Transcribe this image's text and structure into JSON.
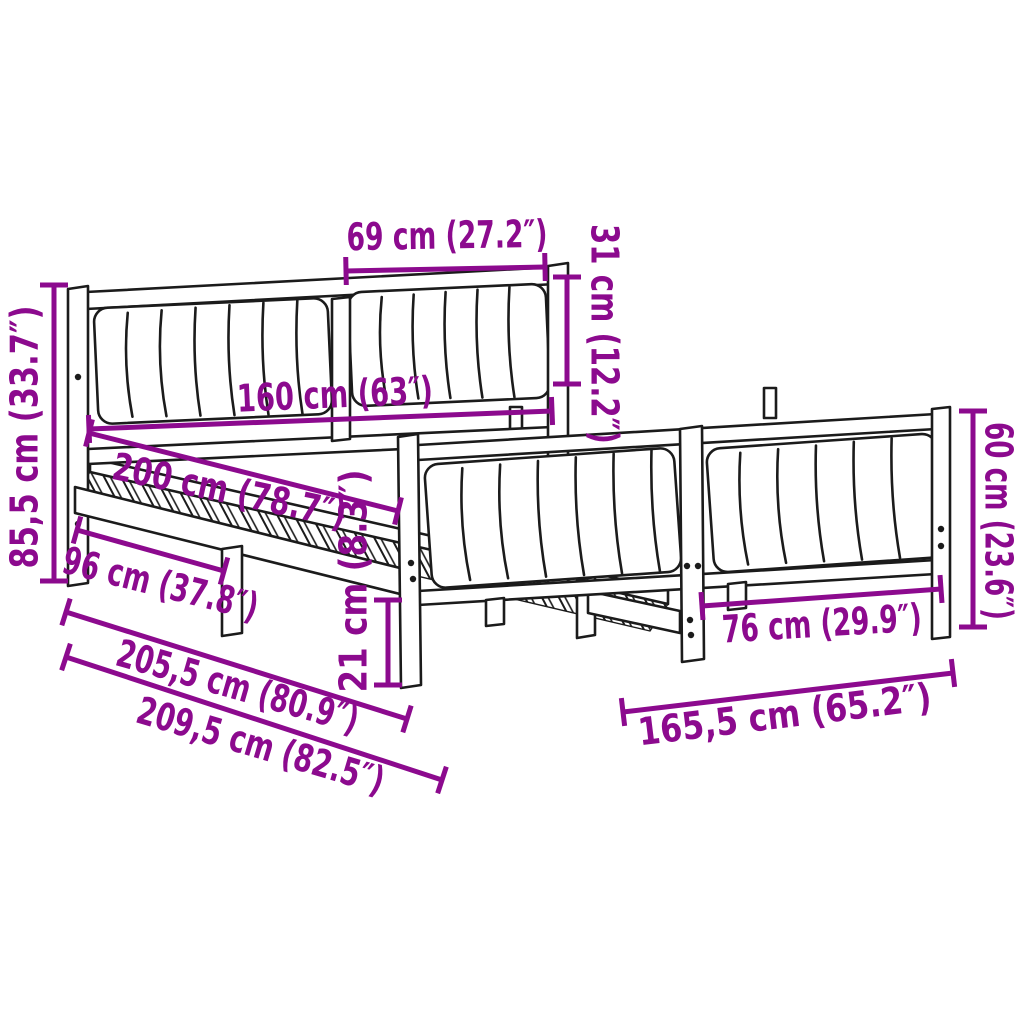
{
  "meta": {
    "description": "Bed frame with upholstered headboard and footboard - product dimension diagram",
    "background": "#ffffff"
  },
  "colors": {
    "dimension": "#8c0a8e",
    "line_art": "#1b1b1b"
  },
  "dimensions": [
    {
      "id": "headboard-cushion-width",
      "label": "69 cm (27.2″)",
      "line": {
        "x1": 346,
        "y1": 271,
        "x2": 545,
        "y2": 267
      },
      "text": {
        "x": 447,
        "y": 238,
        "rotate": -1,
        "len": 201
      }
    },
    {
      "id": "headboard-cushion-height",
      "label": "31 cm (12.2″)",
      "line": {
        "x1": 567,
        "y1": 277,
        "x2": 567,
        "y2": 384
      },
      "text": {
        "x": 602,
        "y": 334,
        "rotate": 90,
        "len": 220
      }
    },
    {
      "id": "bed-width",
      "label": "160 cm (63″)",
      "line": {
        "x1": 89,
        "y1": 429,
        "x2": 552,
        "y2": 411
      },
      "text": {
        "x": 335,
        "y": 397,
        "rotate": -2.5,
        "len": 196
      }
    },
    {
      "id": "bed-length",
      "label": "200 cm (78.7″)",
      "line": {
        "x1": 89,
        "y1": 433,
        "x2": 398,
        "y2": 511
      },
      "text": {
        "x": 229,
        "y": 493,
        "rotate": 12,
        "len": 238
      }
    },
    {
      "id": "headboard-height",
      "label": "85,5 cm (33.7″)",
      "line": {
        "x1": 54,
        "y1": 285,
        "x2": 54,
        "y2": 581
      },
      "text": {
        "x": 27,
        "y": 437,
        "rotate": -90,
        "len": 263
      }
    },
    {
      "id": "head-to-center-leg",
      "label": "96 cm (37.8″)",
      "line": {
        "x1": 77,
        "y1": 530,
        "x2": 224,
        "y2": 571
      },
      "text": {
        "x": 160,
        "y": 586,
        "rotate": 14,
        "len": 200
      }
    },
    {
      "id": "frame-length-inner",
      "label": "205,5 cm (80.9″)",
      "line": {
        "x1": 66,
        "y1": 612,
        "x2": 407,
        "y2": 719
      },
      "text": {
        "x": 237,
        "y": 689,
        "rotate": 16,
        "len": 250
      }
    },
    {
      "id": "frame-length-total",
      "label": "209,5 cm (82.5″)",
      "line": {
        "x1": 66,
        "y1": 657,
        "x2": 442,
        "y2": 780
      },
      "text": {
        "x": 260,
        "y": 748,
        "rotate": 16.5,
        "len": 256
      }
    },
    {
      "id": "leg-height",
      "label": "21 cm (8.3″)",
      "line": {
        "x1": 388,
        "y1": 600,
        "x2": 388,
        "y2": 685
      },
      "text": {
        "x": 356,
        "y": 581,
        "rotate": -90,
        "len": 223
      }
    },
    {
      "id": "footboard-inner-width",
      "label": "76 cm (29.9″)",
      "line": {
        "x1": 702,
        "y1": 606,
        "x2": 941,
        "y2": 589
      },
      "text": {
        "x": 822,
        "y": 626,
        "rotate": -3.5,
        "len": 200
      }
    },
    {
      "id": "footboard-height",
      "label": "60 cm (23.6″)",
      "line": {
        "x1": 973,
        "y1": 411,
        "x2": 973,
        "y2": 627
      },
      "text": {
        "x": 996,
        "y": 521,
        "rotate": 90,
        "len": 198
      }
    },
    {
      "id": "frame-width-total",
      "label": "165,5 cm (65.2″)",
      "line": {
        "x1": 623,
        "y1": 712,
        "x2": 953,
        "y2": 673
      },
      "text": {
        "x": 785,
        "y": 717,
        "rotate": -7,
        "len": 295
      }
    }
  ]
}
